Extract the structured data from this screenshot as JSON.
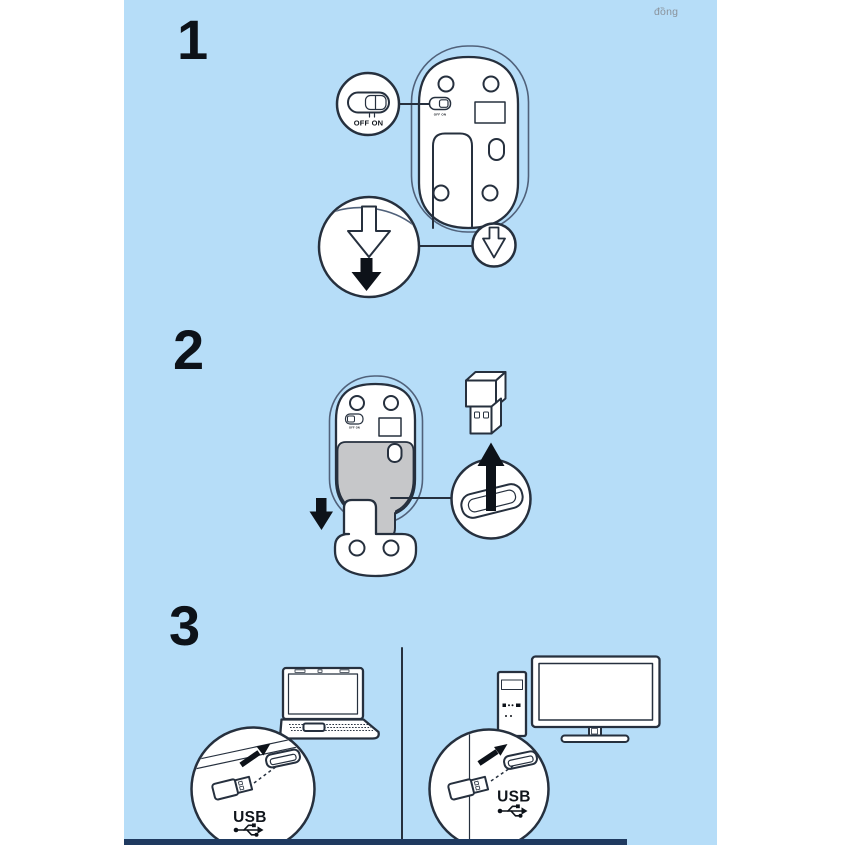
{
  "page": {
    "watermark": "đồng",
    "colors": {
      "page_bg": "#b6ddf8",
      "margin_bg": "#ffffff",
      "line": "#26303e",
      "silhouette_line": "#50617a",
      "ink_black": "#0d1219",
      "battery_gray": "#c6c7c9",
      "footer_bar": "#1f3a60",
      "watermark_gray": "#8a929b"
    }
  },
  "steps": {
    "step1": {
      "number": "1",
      "switch_label": "OFF ON",
      "switch_micro_label": "OFF ON"
    },
    "step2": {
      "number": "2",
      "switch_micro_label": "OFF ON"
    },
    "step3": {
      "number": "3",
      "laptop_usb_label": "USB",
      "desktop_usb_label": "USB"
    }
  }
}
